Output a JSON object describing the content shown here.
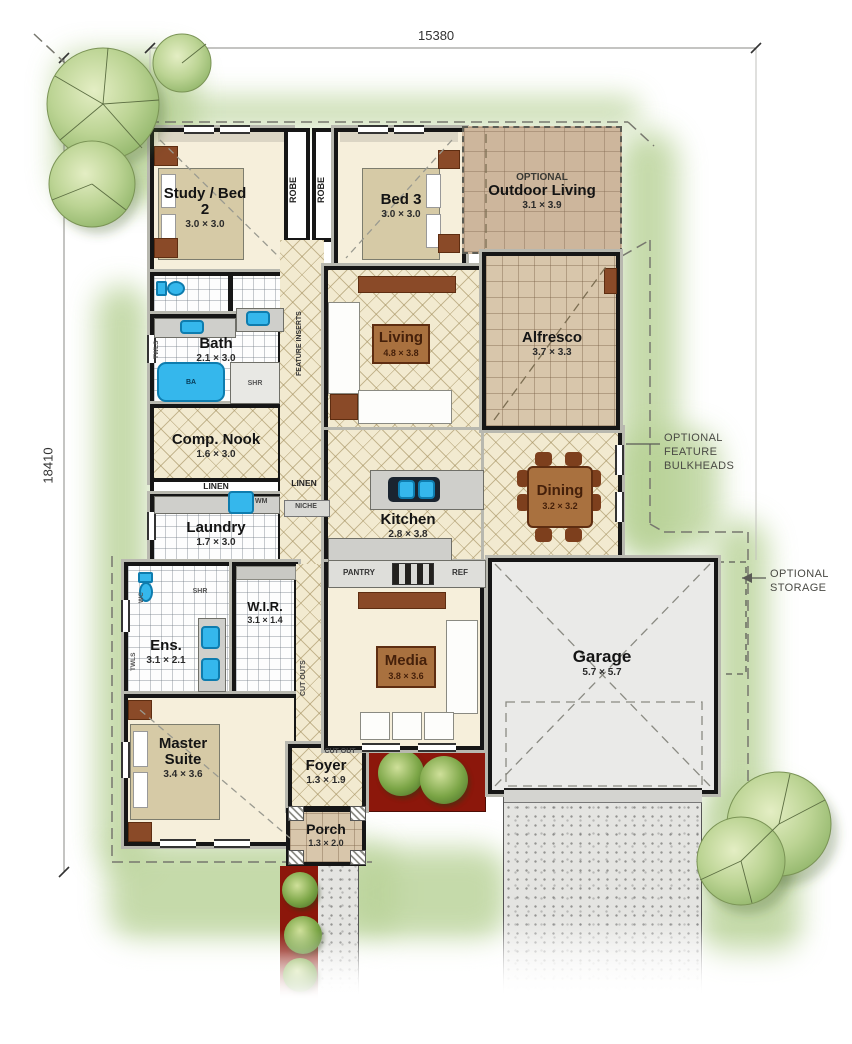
{
  "dimensions": {
    "top": "15380",
    "left": "18410"
  },
  "rooms": {
    "study": {
      "name": "Study / Bed 2",
      "dims": "3.0 × 3.0"
    },
    "bed3": {
      "name": "Bed 3",
      "dims": "3.0 × 3.0"
    },
    "outdoor_living": {
      "tag": "OPTIONAL",
      "name": "Outdoor Living",
      "dims": "3.1 × 3.9"
    },
    "living": {
      "name": "Living",
      "dims": "4.8 × 3.8"
    },
    "alfresco": {
      "name": "Alfresco",
      "dims": "3.7 × 3.3"
    },
    "wc": {
      "name": "wc"
    },
    "pwd": {
      "name": "pwd"
    },
    "bath": {
      "name": "Bath",
      "dims": "2.1 × 3.0"
    },
    "comp_nook": {
      "name": "Comp. Nook",
      "dims": "1.6 × 3.0"
    },
    "laundry": {
      "name": "Laundry",
      "dims": "1.7 × 3.0"
    },
    "kitchen": {
      "name": "Kitchen",
      "dims": "2.8 × 3.8"
    },
    "dining": {
      "name": "Dining",
      "dims": "3.2 × 3.2"
    },
    "ens": {
      "name": "Ens.",
      "dims": "3.1 × 2.1"
    },
    "wir": {
      "name": "W.I.R.",
      "dims": "3.1 × 1.4"
    },
    "master": {
      "name": "Master Suite",
      "dims": "3.4 × 3.6"
    },
    "media": {
      "name": "Media",
      "dims": "3.8 × 3.6"
    },
    "garage": {
      "name": "Garage",
      "dims": "5.7 × 5.7"
    },
    "foyer": {
      "name": "Foyer",
      "dims": "1.3 × 1.9"
    },
    "porch": {
      "name": "Porch",
      "dims": "1.3 × 2.0"
    }
  },
  "labels": {
    "robe": "ROBE",
    "robe2": "ROBE",
    "linen": "LINEN",
    "linen2": "LINEN",
    "niche": "NICHE",
    "wm": "WM",
    "pantry": "PANTRY",
    "ref": "REF",
    "ba": "BA",
    "shr": "SHR",
    "shr2": "SHR",
    "wc_small": "WC",
    "twls": "TWLS",
    "twls2": "TWLS",
    "feature_inserts": "FEATURE INSERTS",
    "cut_out": "CUT OUT",
    "cut_outs": "CUT OUTS"
  },
  "annotations": {
    "bulkheads_line1": "OPTIONAL",
    "bulkheads_line2": "FEATURE",
    "bulkheads_line3": "BULKHEADS",
    "storage_line1": "OPTIONAL",
    "storage_line2": "STORAGE"
  },
  "colors": {
    "fixture_blue": "#2fb3e8",
    "timber_brown": "#a9713f",
    "garden_red": "#8c170b",
    "lawn_green": "#b7d195"
  }
}
